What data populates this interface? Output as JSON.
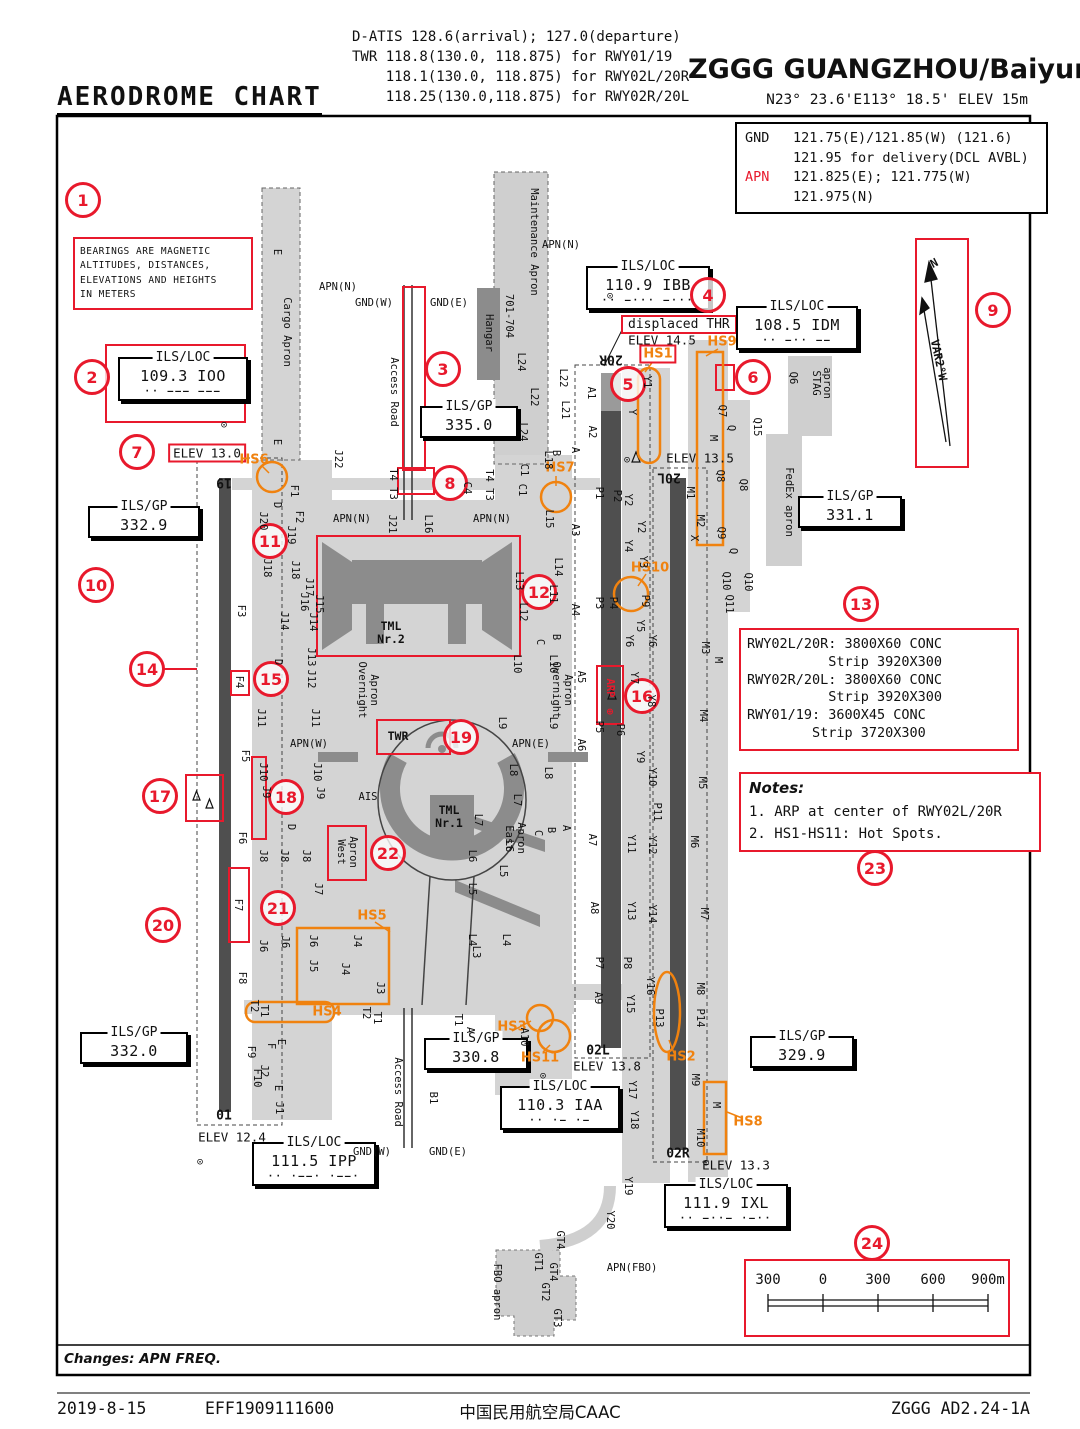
{
  "header": {
    "title": "AERODROME CHART",
    "freq_lines": [
      "D-ATIS 128.6(arrival); 127.0(departure)",
      "TWR 118.8(130.0, 118.875) for RWY01/19",
      "    118.1(130.0, 118.875) for RWY02L/20R",
      "    118.25(130.0,118.875) for RWY02R/20L"
    ],
    "airport": "ZGGG GUANGZHOU/Baiyun",
    "position": "N23° 23.6'E113° 18.5' ELEV 15m"
  },
  "freq_box": {
    "rows": [
      {
        "label": "GND",
        "text": "121.75(E)/121.85(W) (121.6)",
        "red": false
      },
      {
        "label": "",
        "text": "121.95 for delivery(DCL AVBL)",
        "red": false
      },
      {
        "label": "APN",
        "text": "121.825(E); 121.775(W)",
        "red": true
      },
      {
        "label": "",
        "text": "121.975(N)",
        "red": false
      }
    ]
  },
  "bearings_note": [
    "BEARINGS ARE MAGNETIC",
    "ALTITUDES,  DISTANCES,",
    "ELEVATIONS AND HEIGHTS",
    "IN METERS"
  ],
  "misc": {
    "displaced_thr": "displaced THR",
    "changes": "Changes: APN FREQ."
  },
  "runway_info": {
    "lines": [
      "RWY02L/20R: 3800X60 CONC",
      "          Strip 3920X300",
      "RWY02R/20L: 3800X60 CONC",
      "          Strip 3920X300",
      "RWY01/19: 3600X45 CONC",
      "        Strip 3720X300"
    ]
  },
  "notes": {
    "title": "Notes:",
    "items": [
      "1. ARP at center of RWY02L/20R",
      "2. HS1-HS11: Hot Spots."
    ]
  },
  "scale": {
    "marks": [
      {
        "t": "300",
        "x": 768
      },
      {
        "t": "0",
        "x": 823
      },
      {
        "t": "300",
        "x": 878
      },
      {
        "t": "600",
        "x": 933
      },
      {
        "t": "900m",
        "x": 988
      }
    ]
  },
  "nav_boxes": [
    {
      "title": "ILS/LOC",
      "value": "109.3 IOO",
      "morse": "·· ––– –––",
      "x": 118,
      "y": 357,
      "w": 118
    },
    {
      "title": "ILS/GP",
      "value": "335.0",
      "x": 420,
      "y": 406,
      "w": 86
    },
    {
      "title": "ILS/LOC",
      "value": "110.9 IBB",
      "morse": "·· –··· –···",
      "x": 586,
      "y": 266,
      "w": 112
    },
    {
      "title": "ILS/LOC",
      "value": "108.5 IDM",
      "morse": "·· –·· ––",
      "x": 736,
      "y": 306,
      "w": 110
    },
    {
      "title": "ILS/GP",
      "value": "332.9",
      "x": 88,
      "y": 506,
      "w": 100
    },
    {
      "title": "ILS/GP",
      "value": "331.1",
      "x": 798,
      "y": 496,
      "w": 92
    },
    {
      "title": "ILS/GP",
      "value": "330.8",
      "x": 424,
      "y": 1038,
      "w": 92
    },
    {
      "title": "ILS/LOC",
      "value": "110.3 IAA",
      "morse": "·· ·– ·–",
      "x": 500,
      "y": 1086,
      "w": 108
    },
    {
      "title": "ILS/GP",
      "value": "332.0",
      "x": 80,
      "y": 1032,
      "w": 96
    },
    {
      "title": "ILS/LOC",
      "value": "111.5 IPP",
      "morse": "·· ·––· ·––·",
      "x": 252,
      "y": 1142,
      "w": 112
    },
    {
      "title": "ILS/GP",
      "value": "329.9",
      "x": 750,
      "y": 1036,
      "w": 92
    },
    {
      "title": "ILS/LOC",
      "value": "111.9 IXL",
      "morse": "·· –··– ·–··",
      "x": 664,
      "y": 1184,
      "w": 112
    }
  ],
  "elev_labels": [
    {
      "t": "ELEV 13.0",
      "x": 207,
      "y": 453,
      "boxed": true
    },
    {
      "t": "ELEV 14.5",
      "x": 662,
      "y": 340,
      "boxed": false
    },
    {
      "t": "ELEV 13.5",
      "x": 700,
      "y": 458,
      "boxed": false
    },
    {
      "t": "ELEV 13.8",
      "x": 607,
      "y": 1066,
      "boxed": false
    },
    {
      "t": "ELEV 12.4",
      "x": 232,
      "y": 1137,
      "boxed": false
    },
    {
      "t": "ELEV 13.3",
      "x": 736,
      "y": 1165,
      "boxed": false
    }
  ],
  "callouts": [
    [
      1,
      83,
      200
    ],
    [
      2,
      92,
      377
    ],
    [
      3,
      443,
      369
    ],
    [
      4,
      708,
      295
    ],
    [
      5,
      628,
      384
    ],
    [
      6,
      753,
      377
    ],
    [
      7,
      137,
      452
    ],
    [
      8,
      450,
      483
    ],
    [
      9,
      993,
      310
    ],
    [
      10,
      96,
      585
    ],
    [
      11,
      270,
      541
    ],
    [
      12,
      539,
      592
    ],
    [
      13,
      861,
      604
    ],
    [
      14,
      147,
      669
    ],
    [
      15,
      271,
      679
    ],
    [
      16,
      642,
      696
    ],
    [
      17,
      160,
      796
    ],
    [
      18,
      286,
      797
    ],
    [
      19,
      461,
      737
    ],
    [
      20,
      163,
      925
    ],
    [
      21,
      278,
      908
    ],
    [
      22,
      388,
      853
    ],
    [
      23,
      875,
      868
    ],
    [
      24,
      872,
      1243
    ]
  ],
  "hotspots": [
    {
      "id": "HS1",
      "x": 658,
      "y": 354,
      "boxed": true
    },
    {
      "id": "HS2",
      "x": 681,
      "y": 1057,
      "boxed": false
    },
    {
      "id": "HS3",
      "x": 512,
      "y": 1027,
      "boxed": false
    },
    {
      "id": "HS4",
      "x": 327,
      "y": 1012,
      "boxed": false
    },
    {
      "id": "HS5",
      "x": 372,
      "y": 916,
      "boxed": false
    },
    {
      "id": "HS6",
      "x": 254,
      "y": 460,
      "boxed": false
    },
    {
      "id": "HS7",
      "x": 560,
      "y": 468,
      "boxed": false
    },
    {
      "id": "HS8",
      "x": 748,
      "y": 1122,
      "boxed": false
    },
    {
      "id": "HS9",
      "x": 722,
      "y": 342,
      "boxed": false
    },
    {
      "id": "HS10",
      "x": 650,
      "y": 568,
      "boxed": false
    },
    {
      "id": "HS11",
      "x": 540,
      "y": 1058,
      "boxed": false
    }
  ],
  "runway_labels": [
    [
      "19",
      224,
      482,
      180
    ],
    [
      "01",
      224,
      1116,
      0
    ],
    [
      "20R",
      611,
      359,
      180
    ],
    [
      "02L",
      598,
      1051,
      0
    ],
    [
      "20L",
      669,
      477,
      180
    ],
    [
      "02R",
      678,
      1154,
      0
    ]
  ],
  "map_labels": [
    [
      "E",
      277,
      252,
      90
    ],
    [
      "Cargo Apron",
      287,
      332,
      90
    ],
    [
      "E",
      277,
      442,
      90
    ],
    [
      "APN(N)",
      338,
      287,
      0
    ],
    [
      "GND(W)",
      374,
      303,
      0
    ],
    [
      "GND(E)",
      449,
      303,
      0
    ],
    [
      "Access Road",
      394,
      392,
      90
    ],
    [
      "Hangar",
      489,
      333,
      90
    ],
    [
      "701-704",
      509,
      316,
      90
    ],
    [
      "Maintenance Apron",
      534,
      242,
      90
    ],
    [
      "APN(N)",
      561,
      245,
      0
    ],
    [
      "J22",
      338,
      459,
      90
    ],
    [
      "L24",
      521,
      362,
      90
    ],
    [
      "L22",
      534,
      397,
      90
    ],
    [
      "L24",
      523,
      432,
      90
    ],
    [
      "L22",
      563,
      378,
      90
    ],
    [
      "L21",
      565,
      410,
      90
    ],
    [
      "L18",
      548,
      460,
      90
    ],
    [
      "C1",
      524,
      470,
      90
    ],
    [
      "C1",
      522,
      490,
      90
    ],
    [
      "C4",
      467,
      488,
      90
    ],
    [
      "T4 T3",
      489,
      485,
      90
    ],
    [
      "T4 T3",
      393,
      484,
      90
    ],
    [
      "A1",
      591,
      393,
      90
    ],
    [
      "A2",
      592,
      432,
      90
    ],
    [
      "A",
      575,
      450,
      90
    ],
    [
      "B",
      556,
      453,
      90
    ],
    [
      "P1",
      599,
      493,
      90
    ],
    [
      "P2",
      617,
      496,
      90
    ],
    [
      "F1",
      294,
      491,
      90
    ],
    [
      "F2",
      299,
      517,
      90
    ],
    [
      "F3",
      241,
      611,
      90
    ],
    [
      "F4",
      239,
      682,
      90
    ],
    [
      "F5",
      245,
      756,
      90
    ],
    [
      "F6",
      242,
      838,
      90
    ],
    [
      "F7",
      238,
      905,
      90
    ],
    [
      "F8",
      242,
      978,
      90
    ],
    [
      "F9",
      251,
      1052,
      90
    ],
    [
      "F10",
      257,
      1078,
      90
    ],
    [
      "J20",
      263,
      521,
      90
    ],
    [
      "D",
      277,
      505,
      90
    ],
    [
      "J19",
      291,
      535,
      90
    ],
    [
      "J18",
      267,
      568,
      90
    ],
    [
      "J18",
      295,
      570,
      90
    ],
    [
      "J17",
      309,
      587,
      90
    ],
    [
      "J16",
      304,
      602,
      90
    ],
    [
      "J15",
      319,
      604,
      90
    ],
    [
      "J14",
      284,
      621,
      90
    ],
    [
      "J14",
      313,
      622,
      90
    ],
    [
      "J13",
      311,
      657,
      90
    ],
    [
      "J12",
      311,
      679,
      90
    ],
    [
      "D",
      278,
      662,
      90
    ],
    [
      "J11",
      261,
      718,
      90
    ],
    [
      "J11",
      315,
      718,
      90
    ],
    [
      "J10",
      263,
      772,
      90
    ],
    [
      "J10",
      317,
      772,
      90
    ],
    [
      "J9",
      266,
      792,
      90
    ],
    [
      "J9",
      320,
      793,
      90
    ],
    [
      "D",
      291,
      827,
      90
    ],
    [
      "J8",
      263,
      856,
      90
    ],
    [
      "J8",
      284,
      856,
      90
    ],
    [
      "J8",
      306,
      856,
      90
    ],
    [
      "J7",
      318,
      889,
      90
    ],
    [
      "J6",
      263,
      946,
      90
    ],
    [
      "J6",
      285,
      942,
      90
    ],
    [
      "J6",
      313,
      941,
      90
    ],
    [
      "J5",
      313,
      966,
      90
    ],
    [
      "J4",
      357,
      941,
      90
    ],
    [
      "J4",
      345,
      969,
      90
    ],
    [
      "J3",
      380,
      988,
      90
    ],
    [
      "T2",
      254,
      1006,
      90
    ],
    [
      "T1",
      264,
      1011,
      90
    ],
    [
      "T2",
      366,
      1013,
      90
    ],
    [
      "T1",
      377,
      1018,
      90
    ],
    [
      "E",
      281,
      1042,
      90
    ],
    [
      "F",
      271,
      1046,
      90
    ],
    [
      "J2",
      264,
      1071,
      90
    ],
    [
      "E",
      278,
      1088,
      90
    ],
    [
      "J1",
      279,
      1108,
      90
    ],
    [
      "Access Road",
      398,
      1092,
      90
    ],
    [
      "B1",
      433,
      1098,
      90
    ],
    [
      "GND(W)",
      372,
      1152,
      0
    ],
    [
      "GND(E)",
      448,
      1152,
      0
    ],
    [
      "J21",
      392,
      524,
      90
    ],
    [
      "L16",
      428,
      524,
      90
    ],
    [
      "APN(N)",
      352,
      519,
      0
    ],
    [
      "APN(N)",
      492,
      519,
      0
    ],
    [
      "L15",
      549,
      519,
      90
    ],
    [
      "L14",
      558,
      567,
      90
    ],
    [
      "L13",
      519,
      581,
      90
    ],
    [
      "L12",
      523,
      612,
      90
    ],
    [
      "L11",
      553,
      594,
      90
    ],
    [
      "B",
      556,
      637,
      90
    ],
    [
      "C",
      540,
      642,
      90
    ],
    [
      "L10",
      517,
      664,
      90
    ],
    [
      "L10",
      553,
      664,
      90
    ],
    [
      "Overnight",
      362,
      690,
      90
    ],
    [
      "Apron",
      374,
      690,
      90
    ],
    [
      "Overnight",
      556,
      690,
      90
    ],
    [
      "Apron",
      568,
      690,
      90
    ],
    [
      "L9",
      502,
      723,
      90
    ],
    [
      "L9",
      553,
      723,
      90
    ],
    [
      "APN(W)",
      309,
      744,
      0
    ],
    [
      "APN(E)",
      531,
      744,
      0
    ],
    [
      "AIS",
      368,
      797,
      0
    ],
    [
      "TML",
      391,
      626,
      0,
      "b"
    ],
    [
      "Nr.2",
      391,
      639,
      0,
      "b"
    ],
    [
      "TML",
      449,
      810,
      0,
      "b"
    ],
    [
      "Nr.1",
      449,
      823,
      0,
      "b"
    ],
    [
      "TWR",
      398,
      736,
      0,
      "b"
    ],
    [
      "West",
      341,
      852,
      90
    ],
    [
      "Apron",
      353,
      852,
      90
    ],
    [
      "East",
      509,
      838,
      90
    ],
    [
      "Apron",
      521,
      838,
      90
    ],
    [
      "L8",
      513,
      770,
      90
    ],
    [
      "L8",
      548,
      773,
      90
    ],
    [
      "L7",
      517,
      800,
      90
    ],
    [
      "L7",
      478,
      820,
      90
    ],
    [
      "L6",
      509,
      846,
      90
    ],
    [
      "L6",
      472,
      856,
      90
    ],
    [
      "L5",
      503,
      871,
      90
    ],
    [
      "L5",
      472,
      889,
      90
    ],
    [
      "C",
      538,
      833,
      90
    ],
    [
      "B",
      551,
      830,
      90
    ],
    [
      "A",
      566,
      828,
      90
    ],
    [
      "L4",
      472,
      940,
      90
    ],
    [
      "L4",
      506,
      940,
      90
    ],
    [
      "L3",
      476,
      952,
      90
    ],
    [
      "A3",
      575,
      530,
      90
    ],
    [
      "A4",
      575,
      610,
      90
    ],
    [
      "A5",
      581,
      677,
      90
    ],
    [
      "A6",
      581,
      745,
      90
    ],
    [
      "A7",
      592,
      840,
      90
    ],
    [
      "A8",
      594,
      908,
      90
    ],
    [
      "A9",
      598,
      998,
      90
    ],
    [
      "A10",
      524,
      1037,
      90
    ],
    [
      "T1",
      458,
      1020,
      90
    ],
    [
      "A",
      470,
      1030,
      90
    ],
    [
      "P3",
      599,
      603,
      90
    ],
    [
      "P4",
      613,
      603,
      90
    ],
    [
      "P5",
      599,
      727,
      90
    ],
    [
      "P6",
      620,
      730,
      90
    ],
    [
      "P7",
      599,
      963,
      90
    ],
    [
      "P8",
      627,
      963,
      90
    ],
    [
      "P9",
      645,
      601,
      90
    ],
    [
      "P11",
      657,
      812,
      90
    ],
    [
      "P13",
      659,
      1018,
      90
    ],
    [
      "P14",
      700,
      1018,
      90
    ],
    [
      "Y1",
      647,
      382,
      90
    ],
    [
      "Y",
      632,
      412,
      90
    ],
    [
      "Y2",
      628,
      500,
      90
    ],
    [
      "Y2",
      641,
      527,
      90
    ],
    [
      "Y4",
      628,
      546,
      90
    ],
    [
      "Y3",
      643,
      562,
      90
    ],
    [
      "Y5",
      640,
      626,
      90
    ],
    [
      "Y6",
      629,
      641,
      90
    ],
    [
      "Y6",
      652,
      641,
      90
    ],
    [
      "Y7",
      634,
      678,
      90
    ],
    [
      "Y8",
      651,
      701,
      90
    ],
    [
      "Y9",
      640,
      757,
      90
    ],
    [
      "Y10",
      652,
      777,
      90
    ],
    [
      "Y11",
      631,
      844,
      90
    ],
    [
      "Y12",
      652,
      845,
      90
    ],
    [
      "Y13",
      631,
      911,
      90
    ],
    [
      "Y14",
      652,
      914,
      90
    ],
    [
      "Y16",
      650,
      986,
      90
    ],
    [
      "Y15",
      630,
      1004,
      90
    ],
    [
      "Y17",
      632,
      1090,
      90
    ],
    [
      "Y18",
      634,
      1120,
      90
    ],
    [
      "Y19",
      628,
      1186,
      90
    ],
    [
      "Y20",
      610,
      1220,
      90
    ],
    [
      "M1",
      690,
      493,
      90
    ],
    [
      "M2",
      700,
      521,
      90
    ],
    [
      "X",
      694,
      538,
      90
    ],
    [
      "M",
      713,
      438,
      90
    ],
    [
      "M3",
      705,
      648,
      90
    ],
    [
      "M",
      718,
      660,
      90
    ],
    [
      "M4",
      703,
      716,
      90
    ],
    [
      "M5",
      702,
      783,
      90
    ],
    [
      "M6",
      694,
      842,
      90
    ],
    [
      "M7",
      704,
      914,
      90
    ],
    [
      "M8",
      700,
      989,
      90
    ],
    [
      "M9",
      695,
      1080,
      90
    ],
    [
      "M",
      716,
      1105,
      90
    ],
    [
      "M10",
      700,
      1138,
      90
    ],
    [
      "Q7",
      722,
      411,
      90
    ],
    [
      "Q",
      731,
      428,
      90
    ],
    [
      "Q8",
      720,
      476,
      90
    ],
    [
      "Q8",
      743,
      485,
      90
    ],
    [
      "Q15",
      757,
      427,
      90
    ],
    [
      "Q9",
      721,
      533,
      90
    ],
    [
      "Q",
      733,
      551,
      90
    ],
    [
      "Q10",
      726,
      581,
      90
    ],
    [
      "Q10",
      748,
      582,
      90
    ],
    [
      "Q11",
      729,
      604,
      90
    ],
    [
      "Q6",
      793,
      378,
      90
    ],
    [
      "STAG",
      816,
      383,
      90
    ],
    [
      "apron",
      827,
      383,
      90
    ],
    [
      "FedEx apron",
      789,
      502,
      90
    ],
    [
      "GT4",
      560,
      1240,
      90
    ],
    [
      "GT1",
      538,
      1262,
      90
    ],
    [
      "GT4",
      553,
      1272,
      90
    ],
    [
      "GT2",
      545,
      1292,
      90
    ],
    [
      "GT3",
      557,
      1318,
      90
    ],
    [
      "FBO apron",
      497,
      1292,
      90
    ],
    [
      "APN(FBO)",
      632,
      1268,
      0
    ],
    [
      "⊙",
      610,
      296,
      0
    ],
    [
      "⊙",
      224,
      425,
      0
    ],
    [
      "⊙",
      543,
      1076,
      0
    ],
    [
      "⊙",
      200,
      1162,
      0
    ],
    [
      "⊙",
      706,
      1163,
      0
    ],
    [
      "⊙",
      627,
      460,
      0
    ],
    [
      "ARP",
      610,
      688,
      90,
      "red"
    ],
    [
      "⊕",
      610,
      712,
      0,
      "red"
    ],
    [
      "N",
      934,
      263,
      -28,
      "b"
    ],
    [
      "VAR2°W",
      939,
      360,
      78,
      "b"
    ]
  ],
  "footer": {
    "date": "2019-8-15",
    "eff": "EFF1909111600",
    "authority": "中国民用航空局CAAC",
    "chart_id": "ZGGG AD2.24-1A"
  }
}
